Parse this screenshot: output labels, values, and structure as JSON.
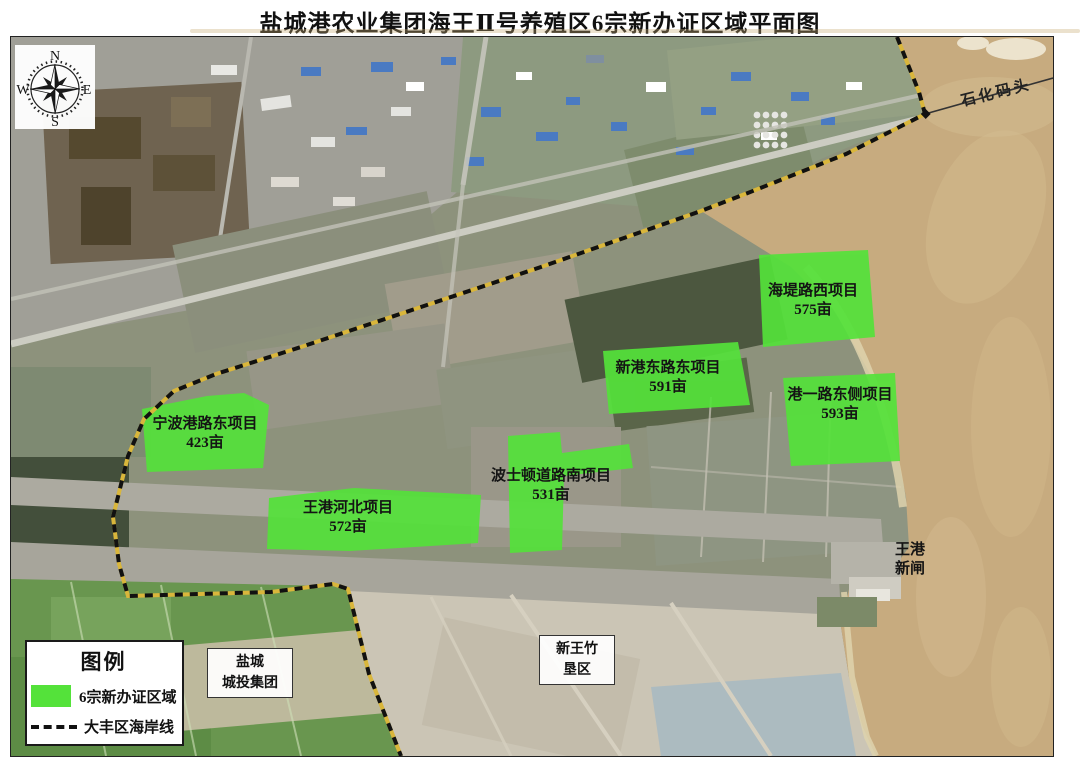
{
  "title": "盐城港农业集团海王Ⅱ号养殖区6宗新办证区域平面图",
  "compass": {
    "north": "N",
    "south": "S",
    "east": "E",
    "west": "W"
  },
  "parcels": [
    {
      "name": "海堤路西项目",
      "area": "575亩"
    },
    {
      "name": "新港东路东项目",
      "area": "591亩"
    },
    {
      "name": "港一路东侧项目",
      "area": "593亩"
    },
    {
      "name": "宁波港路东项目",
      "area": "423亩"
    },
    {
      "name": "波士顿道路南项目",
      "area": "531亩"
    },
    {
      "name": "王港河北项目",
      "area": "572亩"
    }
  ],
  "map_labels": {
    "pier": "石化码头",
    "sluice": {
      "line1": "王港",
      "line2": "新闸"
    },
    "yancheng_box": {
      "line1": "盐城",
      "line2": "城投集团"
    },
    "xinwangzhu_box": {
      "line1": "新王竹",
      "line2": "垦区"
    }
  },
  "legend": {
    "title": "图例",
    "items": [
      {
        "swatch": "green-area",
        "label": "6宗新办证区域"
      },
      {
        "swatch": "dashed-line",
        "label": "大丰区海岸线"
      }
    ]
  },
  "colors": {
    "parcel_green": "#54e23a",
    "sea_tan": "#c7ab7f",
    "coastline_yellow": "#d9b63b",
    "coastline_black": "#111111"
  }
}
